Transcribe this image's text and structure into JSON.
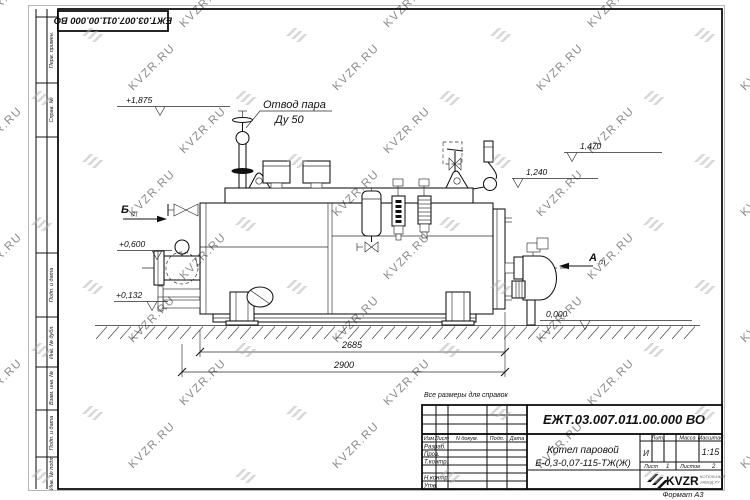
{
  "sheet": {
    "note": "Все размеры для справок",
    "format_label": "Формат А3",
    "watermark_text": "KVZR.RU",
    "watermark_color": "#b0b0b0"
  },
  "top_stamp": {
    "doc_number": "ЕЖТ.03.007.011.00.000 ВО"
  },
  "margin_labels": [
    "Перв. примен.",
    "Справ. №",
    "Подп. и дата",
    "Инв. № дубл.",
    "Взам. инв. №",
    "Подп. и дата",
    "Инв. № подл."
  ],
  "drawing": {
    "callout": {
      "line1": "Отвод пара",
      "line2": "Ду 50"
    },
    "levels": {
      "top": "+1,875",
      "mid": "+0,600",
      "low": "+0,132",
      "zero": "0,000",
      "right_top": "1,470",
      "right_mid": "1,240"
    },
    "dimensions": {
      "inner": "2685",
      "outer": "2900"
    },
    "views": {
      "b": "Б",
      "a": "А",
      "ref": "(2)"
    }
  },
  "title_block": {
    "doc_number": "ЕЖТ.03.007.011.00.000  ВО",
    "product_line1": "Котел паровой",
    "product_line2": "Е-0,3-0,07-115-ТЖ(Ж)",
    "col_izm": "Изм",
    "col_list": "Лист",
    "col_ndoc": "N докум.",
    "col_podp": "Подп.",
    "col_data": "Дата",
    "row_labels": [
      "Разраб.",
      "Пров.",
      "Т.контр.",
      "Н.контр.",
      "Утв."
    ],
    "lit_label": "Лит.",
    "lit_value": "И",
    "mass_label": "Масса",
    "scale_label": "Масштаб",
    "scale_value": "1:15",
    "sheet_label": "Лист",
    "sheet_value": "1",
    "sheets_label": "Листов",
    "sheets_value": "2",
    "logo_text": "KVZR",
    "logo_caption1": "КОТЕЛЬНЫЙ",
    "logo_caption2": "ЗАВОД.РУ"
  }
}
